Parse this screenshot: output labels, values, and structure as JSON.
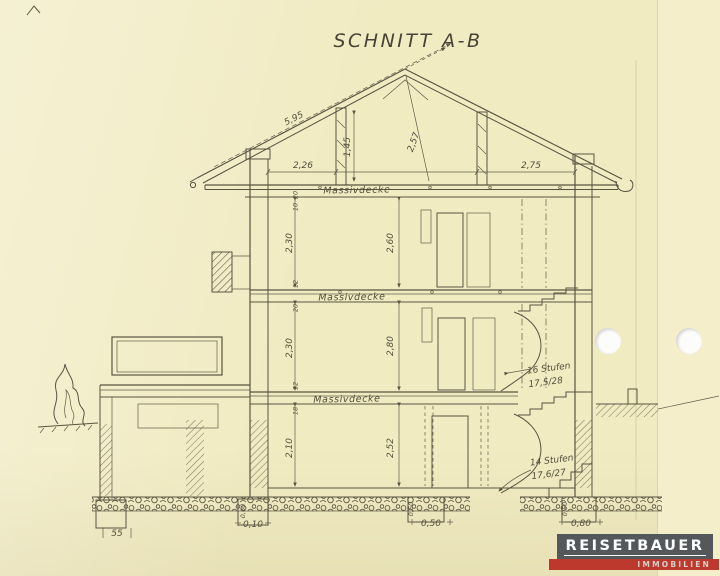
{
  "page": {
    "title_block": "SCHNITT A-B"
  },
  "paper": {
    "background": "#f1ebc2",
    "ink": "#4c4636"
  },
  "roof": {
    "rafter_length": "5,95",
    "bay_left": "2,26",
    "bay_right": "2,75",
    "post_height": "1,45",
    "ridge_height": "2,57",
    "slab_label": "Massivdecke",
    "thk_top": "20",
    "thk_bottom": "10"
  },
  "upper_floor": {
    "height_left": "2,30",
    "height_center": "2,60",
    "slab_label": "Massivdecke",
    "thk_top": "12",
    "thk_bottom": "20"
  },
  "ground_floor": {
    "height_left": "2,30",
    "height_center": "2,80",
    "slab_label": "Massivdecke",
    "thk_top": "12",
    "thk_bottom": "18"
  },
  "basement": {
    "height_left": "2,10",
    "height_center": "2,52"
  },
  "stairs": {
    "upper_count": "16 Stufen",
    "upper_ratio": "17,5/28",
    "lower_count": "14 Stufen",
    "lower_ratio": "17,6/27"
  },
  "foundation": {
    "dim_left": "55",
    "dim_wall": "0,10",
    "dim_mid": "0,50",
    "dim_right": "0,80",
    "depth_a": "0,60",
    "depth_b": "0,50",
    "depth_c": "0,50"
  },
  "logo": {
    "brand": "REISETBAUER",
    "division": "IMMOBILIEN",
    "bar_color": "#54585a",
    "accent_color": "#bd382d",
    "text_color": "#ffffff"
  }
}
